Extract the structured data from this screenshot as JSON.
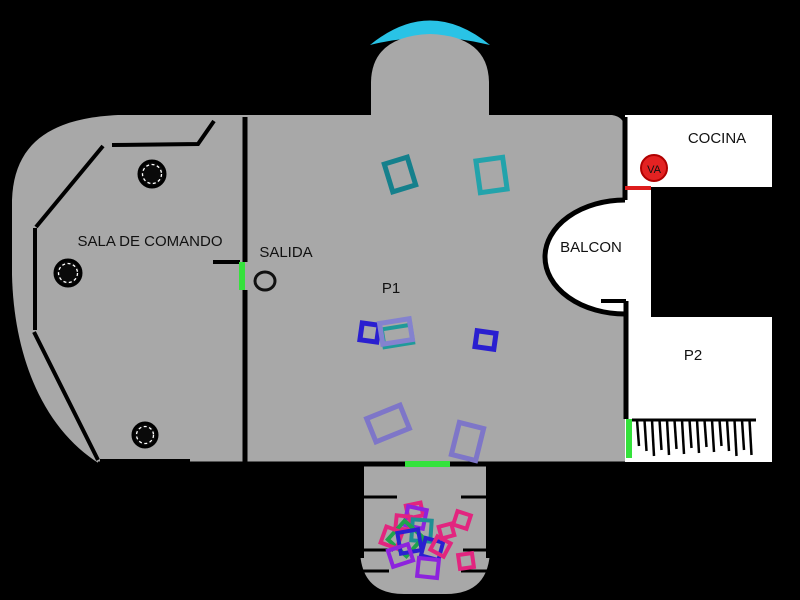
{
  "rooms": {
    "sala_de_comando": {
      "label": "SALA DE COMANDO"
    },
    "salida": {
      "label": "SALIDA"
    },
    "p1": {
      "label": "P1"
    },
    "balcon": {
      "label": "BALCON"
    },
    "cocina": {
      "label": "COCINA"
    },
    "p2": {
      "label": "P2"
    },
    "lava_tag": {
      "label": "VA"
    }
  },
  "palette": {
    "background": "#000000",
    "floor_gray": "#a8a8a8",
    "room_white": "#ffffff",
    "dome_cyan": "#29c3e6",
    "door_green": "#35e23c",
    "alert_red": "#dd2020",
    "alert_red_dark": "#8a1212",
    "wall_black": "#000000",
    "marker_teal_dark": "#15808c",
    "marker_teal": "#23a3ab",
    "marker_blue": "#2a1fd0",
    "marker_slate": "#8482cf",
    "marker_purple": "#8d23dd",
    "marker_pink": "#e2257f",
    "marker_green": "#1fa34c"
  },
  "markers": [
    {
      "x": 388,
      "y": 160,
      "w": 24,
      "h": 29,
      "rot": -17,
      "color": "#15808c",
      "sw": 5
    },
    {
      "x": 478,
      "y": 159,
      "w": 27,
      "h": 32,
      "rot": -8,
      "color": "#23a3ab",
      "sw": 5
    },
    {
      "x": 361,
      "y": 324,
      "w": 17,
      "h": 17,
      "rot": 8,
      "color": "#2a1fd0",
      "sw": 5
    },
    {
      "x": 383,
      "y": 327,
      "w": 29,
      "h": 18,
      "rot": -9,
      "color": "#1f9a9a",
      "sw": 4
    },
    {
      "x": 381,
      "y": 321,
      "w": 30,
      "h": 21,
      "rot": -9,
      "color": "#8482cf",
      "sw": 5
    },
    {
      "x": 476,
      "y": 332,
      "w": 19,
      "h": 16,
      "rot": 8,
      "color": "#2a1fd0",
      "sw": 5
    },
    {
      "x": 370,
      "y": 411,
      "w": 36,
      "h": 25,
      "rot": -22,
      "color": "#7e76c8",
      "sw": 5
    },
    {
      "x": 455,
      "y": 425,
      "w": 25,
      "h": 33,
      "rot": 14,
      "color": "#7e76c8",
      "sw": 5
    },
    {
      "x": 407,
      "y": 504,
      "w": 15,
      "h": 13,
      "rot": -12,
      "color": "#e2257f",
      "sw": 4
    },
    {
      "x": 406,
      "y": 508,
      "w": 19,
      "h": 19,
      "rot": 12,
      "color": "#8d23dd",
      "sw": 4
    },
    {
      "x": 396,
      "y": 516,
      "w": 14,
      "h": 13,
      "rot": 6,
      "color": "#e2257f",
      "sw": 4
    },
    {
      "x": 412,
      "y": 520,
      "w": 19,
      "h": 21,
      "rot": 4,
      "color": "#1d8f93",
      "sw": 4
    },
    {
      "x": 393,
      "y": 526,
      "w": 25,
      "h": 25,
      "rot": 42,
      "color": "#1fa34c",
      "sw": 4
    },
    {
      "x": 383,
      "y": 529,
      "w": 17,
      "h": 17,
      "rot": 20,
      "color": "#e2257f",
      "sw": 4
    },
    {
      "x": 399,
      "y": 531,
      "w": 21,
      "h": 21,
      "rot": -10,
      "color": "#2a1fd0",
      "sw": 4
    },
    {
      "x": 423,
      "y": 540,
      "w": 18,
      "h": 18,
      "rot": 15,
      "color": "#2a1fd0",
      "sw": 4
    },
    {
      "x": 433,
      "y": 539,
      "w": 15,
      "h": 15,
      "rot": 28,
      "color": "#e2257f",
      "sw": 4
    },
    {
      "x": 390,
      "y": 547,
      "w": 21,
      "h": 17,
      "rot": -18,
      "color": "#8d23dd",
      "sw": 4
    },
    {
      "x": 418,
      "y": 559,
      "w": 20,
      "h": 18,
      "rot": 6,
      "color": "#8d23dd",
      "sw": 4
    },
    {
      "x": 455,
      "y": 513,
      "w": 14,
      "h": 14,
      "rot": 18,
      "color": "#e2257f",
      "sw": 4
    },
    {
      "x": 459,
      "y": 554,
      "w": 14,
      "h": 14,
      "rot": -8,
      "color": "#e2257f",
      "sw": 4
    },
    {
      "x": 440,
      "y": 525,
      "w": 13,
      "h": 12,
      "rot": -15,
      "color": "#e2257f",
      "sw": 4
    }
  ],
  "comb": {
    "x_start": 637,
    "y_top": 420,
    "count": 16,
    "spacing": 7.5,
    "base_len": 26
  }
}
